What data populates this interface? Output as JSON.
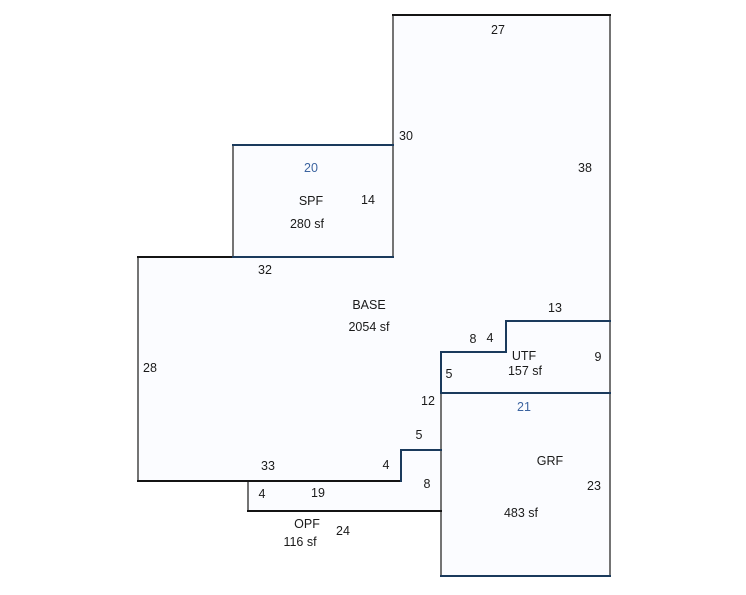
{
  "canvas": {
    "width": 746,
    "height": 595,
    "background": "#ffffff"
  },
  "colors": {
    "area_fill": "#fbfcff",
    "gray": "#747474",
    "black": "#141414",
    "navy": "#1a3a5c",
    "dark": "#1a1a1a",
    "blue": "#3c64a0"
  },
  "areas": [
    {
      "code": "BASE",
      "size": "2054 sf"
    },
    {
      "code": "SPF",
      "size": "280 sf"
    },
    {
      "code": "UTF",
      "size": "157 sf"
    },
    {
      "code": "GRF",
      "size": "483 sf"
    },
    {
      "code": "OPF",
      "size": "116 sf"
    }
  ],
  "sketch": {
    "polygons": [
      {
        "area": "base",
        "points": "393,15 610,15 610,321 506,321 506,352 441,352 441,450 401,450 401,481 138,481 138,257 393,257"
      },
      {
        "area": "spf",
        "points": "233,145 393,145 393,257 233,257"
      },
      {
        "area": "utf",
        "points": "506,321 610,321 610,393 441,393 441,352 506,352"
      },
      {
        "area": "grf",
        "points": "441,393 610,393 610,576 441,576"
      },
      {
        "area": "opf",
        "points": "248,481 401,481 401,450 441,450 441,511 248,511"
      }
    ],
    "segments": [
      {
        "name": "wall-base-right-upper",
        "x1": 393,
        "y1": 14,
        "x2": 393,
        "y2": 257,
        "color": "gray"
      },
      {
        "name": "wall-spf-left",
        "x1": 233,
        "y1": 144,
        "x2": 233,
        "y2": 258,
        "color": "gray"
      },
      {
        "name": "wall-base-left",
        "x1": 138,
        "y1": 256,
        "x2": 138,
        "y2": 482,
        "color": "gray"
      },
      {
        "name": "wall-right-outer",
        "x1": 610,
        "y1": 14,
        "x2": 610,
        "y2": 577,
        "color": "gray"
      },
      {
        "name": "wall-grf-left",
        "x1": 441,
        "y1": 393,
        "x2": 441,
        "y2": 577,
        "color": "gray"
      },
      {
        "name": "wall-opf-left",
        "x1": 248,
        "y1": 480,
        "x2": 248,
        "y2": 512,
        "color": "gray"
      },
      {
        "name": "wall-base-top",
        "x1": 392,
        "y1": 15,
        "x2": 611,
        "y2": 15,
        "color": "black"
      },
      {
        "name": "wall-base-topleft",
        "x1": 137,
        "y1": 257,
        "x2": 234,
        "y2": 257,
        "color": "black"
      },
      {
        "name": "wall-base-bottom",
        "x1": 137,
        "y1": 481,
        "x2": 402,
        "y2": 481,
        "color": "black"
      },
      {
        "name": "wall-opf-bottom",
        "x1": 247,
        "y1": 511,
        "x2": 442,
        "y2": 511,
        "color": "black"
      },
      {
        "name": "wall-spf-top",
        "x1": 232,
        "y1": 145,
        "x2": 394,
        "y2": 145,
        "color": "navy"
      },
      {
        "name": "wall-spf-bottom",
        "x1": 232,
        "y1": 257,
        "x2": 394,
        "y2": 257,
        "color": "navy"
      },
      {
        "name": "wall-utf-top",
        "x1": 505,
        "y1": 321,
        "x2": 611,
        "y2": 321,
        "color": "navy"
      },
      {
        "name": "wall-utf-step-vert",
        "x1": 506,
        "y1": 320,
        "x2": 506,
        "y2": 353,
        "color": "navy"
      },
      {
        "name": "wall-utf-step-horiz",
        "x1": 440,
        "y1": 352,
        "x2": 507,
        "y2": 352,
        "color": "navy"
      },
      {
        "name": "wall-utf-left",
        "x1": 441,
        "y1": 351,
        "x2": 441,
        "y2": 394,
        "color": "navy"
      },
      {
        "name": "wall-utf-grf-divider",
        "x1": 440,
        "y1": 393,
        "x2": 611,
        "y2": 393,
        "color": "navy"
      },
      {
        "name": "wall-grf-bottom",
        "x1": 440,
        "y1": 576,
        "x2": 611,
        "y2": 576,
        "color": "navy"
      },
      {
        "name": "wall-base-step-horiz",
        "x1": 400,
        "y1": 450,
        "x2": 442,
        "y2": 450,
        "color": "navy"
      },
      {
        "name": "wall-base-step-vert",
        "x1": 401,
        "y1": 449,
        "x2": 401,
        "y2": 482,
        "color": "navy"
      }
    ],
    "labels": [
      {
        "name": "dim-label-27",
        "text": "27",
        "x": 498,
        "y": 30,
        "color": "dark"
      },
      {
        "name": "dim-label-30",
        "text": "30",
        "x": 406,
        "y": 136,
        "color": "dark"
      },
      {
        "name": "dim-label-38",
        "text": "38",
        "x": 585,
        "y": 168,
        "color": "dark"
      },
      {
        "name": "dim-label-20",
        "text": "20",
        "x": 311,
        "y": 168,
        "color": "blue"
      },
      {
        "name": "area-label-spf",
        "text": "SPF",
        "x": 311,
        "y": 201,
        "color": "dark"
      },
      {
        "name": "dim-label-14",
        "text": "14",
        "x": 368,
        "y": 200,
        "color": "dark"
      },
      {
        "name": "area-size-spf",
        "text": "280 sf",
        "x": 307,
        "y": 224,
        "color": "dark"
      },
      {
        "name": "dim-label-32",
        "text": "32",
        "x": 265,
        "y": 270,
        "color": "dark"
      },
      {
        "name": "area-label-base",
        "text": "BASE",
        "x": 369,
        "y": 305,
        "color": "dark"
      },
      {
        "name": "dim-label-13",
        "text": "13",
        "x": 555,
        "y": 308,
        "color": "dark"
      },
      {
        "name": "area-size-base",
        "text": "2054 sf",
        "x": 369,
        "y": 327,
        "color": "dark"
      },
      {
        "name": "dim-label-8-utf",
        "text": "8",
        "x": 473,
        "y": 339,
        "color": "dark"
      },
      {
        "name": "dim-label-4-utf",
        "text": "4",
        "x": 490,
        "y": 338,
        "color": "dark"
      },
      {
        "name": "area-label-utf",
        "text": "UTF",
        "x": 524,
        "y": 356,
        "color": "dark"
      },
      {
        "name": "dim-label-9",
        "text": "9",
        "x": 598,
        "y": 357,
        "color": "dark"
      },
      {
        "name": "dim-label-28",
        "text": "28",
        "x": 150,
        "y": 368,
        "color": "dark"
      },
      {
        "name": "area-size-utf",
        "text": "157 sf",
        "x": 525,
        "y": 371,
        "color": "dark"
      },
      {
        "name": "dim-label-5-utf",
        "text": "5",
        "x": 449,
        "y": 374,
        "color": "dark"
      },
      {
        "name": "dim-label-12",
        "text": "12",
        "x": 428,
        "y": 401,
        "color": "dark"
      },
      {
        "name": "dim-label-21",
        "text": "21",
        "x": 524,
        "y": 407,
        "color": "blue"
      },
      {
        "name": "dim-label-5-step",
        "text": "5",
        "x": 419,
        "y": 435,
        "color": "dark"
      },
      {
        "name": "area-label-grf",
        "text": "GRF",
        "x": 550,
        "y": 461,
        "color": "dark"
      },
      {
        "name": "dim-label-33",
        "text": "33",
        "x": 268,
        "y": 466,
        "color": "dark"
      },
      {
        "name": "dim-label-4-step",
        "text": "4",
        "x": 386,
        "y": 465,
        "color": "dark"
      },
      {
        "name": "dim-label-8-opf",
        "text": "8",
        "x": 427,
        "y": 484,
        "color": "dark"
      },
      {
        "name": "dim-label-23",
        "text": "23",
        "x": 594,
        "y": 486,
        "color": "dark"
      },
      {
        "name": "dim-label-19",
        "text": "19",
        "x": 318,
        "y": 493,
        "color": "dark"
      },
      {
        "name": "dim-label-4-opf",
        "text": "4",
        "x": 262,
        "y": 494,
        "color": "dark"
      },
      {
        "name": "area-size-grf",
        "text": "483 sf",
        "x": 521,
        "y": 513,
        "color": "dark"
      },
      {
        "name": "area-label-opf",
        "text": "OPF",
        "x": 307,
        "y": 524,
        "color": "dark"
      },
      {
        "name": "dim-label-24",
        "text": "24",
        "x": 343,
        "y": 531,
        "color": "dark"
      },
      {
        "name": "area-size-opf",
        "text": "116 sf",
        "x": 300,
        "y": 542,
        "color": "dark"
      }
    ]
  }
}
